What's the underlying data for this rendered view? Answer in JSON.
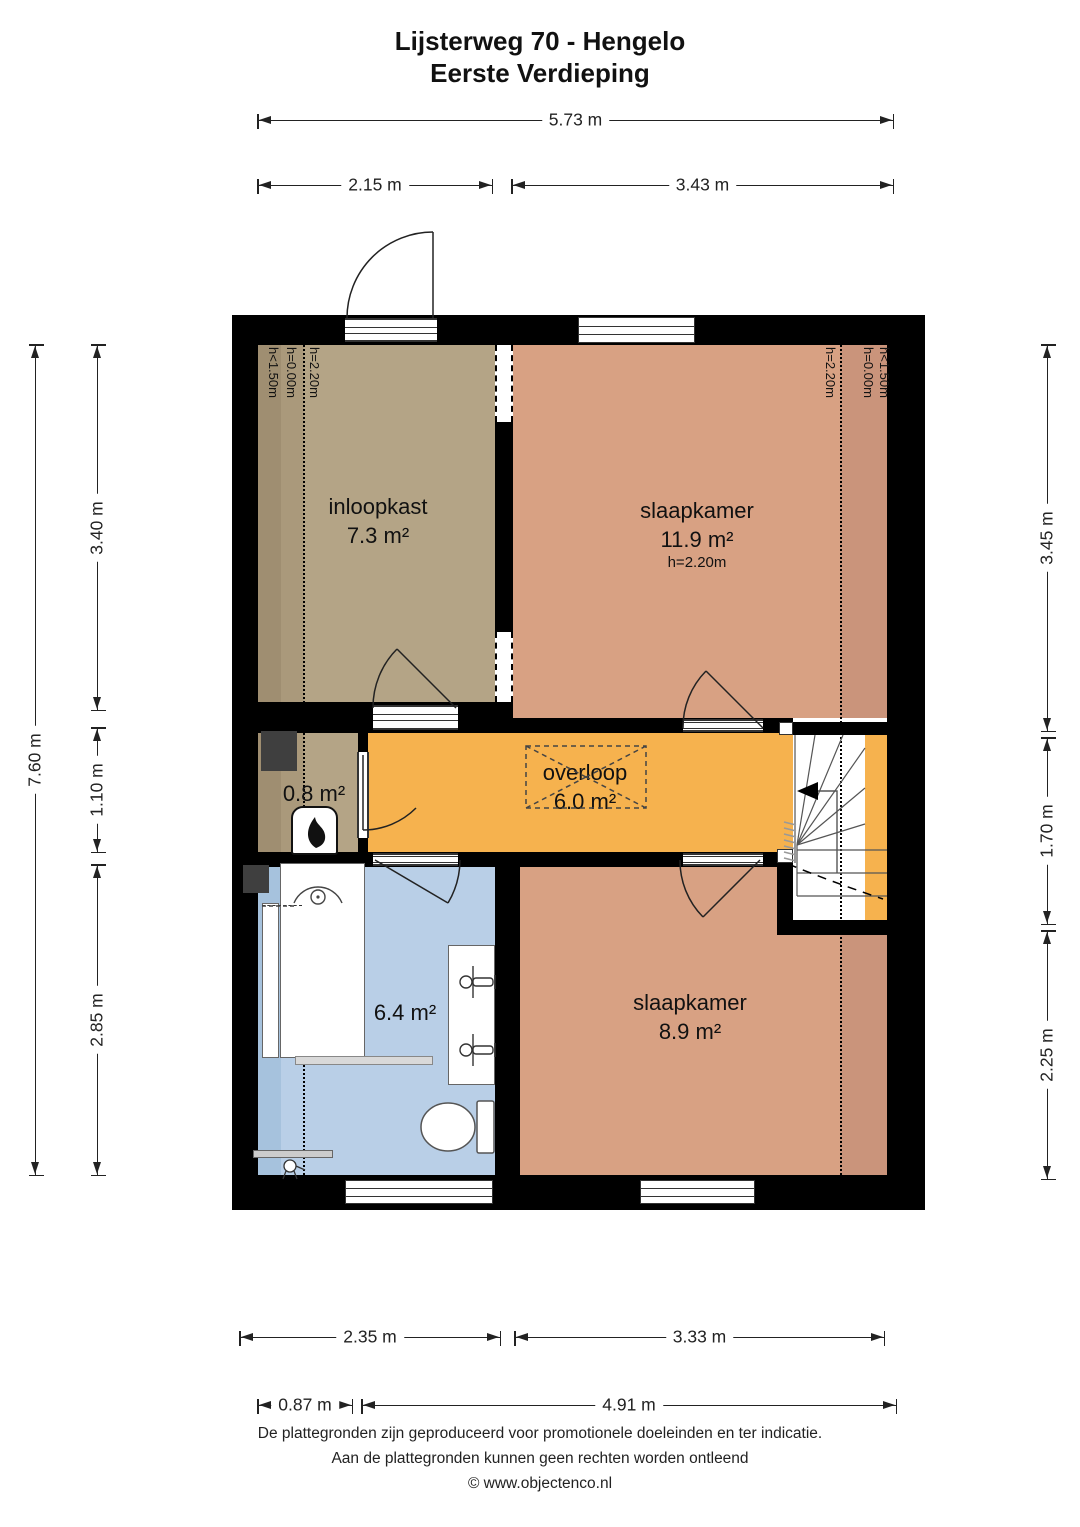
{
  "title": {
    "line1": "Lijsterweg 70 - Hengelo",
    "line2": "Eerste Verdieping"
  },
  "rooms": {
    "inloopkast": {
      "name": "inloopkast",
      "area": "7.3 m²"
    },
    "slaapkamer_1": {
      "name": "slaapkamer",
      "area": "11.9 m²",
      "ceiling": "h=2.20m"
    },
    "overloop": {
      "name": "overloop",
      "area": "6.0 m²"
    },
    "techniek": {
      "area": "0.8 m²"
    },
    "badkamer": {
      "area": "6.4 m²"
    },
    "slaapkamer_2": {
      "name": "slaapkamer",
      "area": "8.9 m²"
    }
  },
  "height_annotations": {
    "inloopkast_wall": "h<1.50m",
    "inloopkast_zero": "h=0.00m",
    "inloopkast_line": "h=2.20m",
    "slaapkamer_line": "h=2.20m",
    "slaapkamer_zero": "h=0.00m",
    "slaapkamer_wall": "h<1.50m"
  },
  "dimensions": {
    "top_total": "5.73 m",
    "top_segments": [
      "2.15 m",
      "3.43 m"
    ],
    "left_total": "7.60 m",
    "left_segments": [
      "3.40 m",
      "1.10 m",
      "2.85 m"
    ],
    "right_segments": [
      "3.45 m",
      "1.70 m",
      "2.25 m"
    ],
    "bottom_row1": [
      "2.35 m",
      "3.33 m"
    ],
    "bottom_row2": [
      "0.87 m",
      "4.91 m"
    ]
  },
  "footer": {
    "line1": "De plattegronden zijn geproduceerd voor promotionele doeleinden en ter indicatie.",
    "line2": "Aan de plattegronden kunnen geen rechten worden ontleend",
    "line3": "© www.objectenco.nl"
  },
  "colors": {
    "wall": "#000000",
    "tan": "#b4a486",
    "tan_dark": "#9f8e71",
    "tan_mid": "#aa997b",
    "salmon": "#d8a183",
    "salmon_dark": "#ca947b",
    "orange": "#f6b24e",
    "blue": "#b9cfe7",
    "blue_dark": "#a6c2dd",
    "stair_floor": "#ffffff",
    "shaft_gray": "#3f3f3f"
  }
}
